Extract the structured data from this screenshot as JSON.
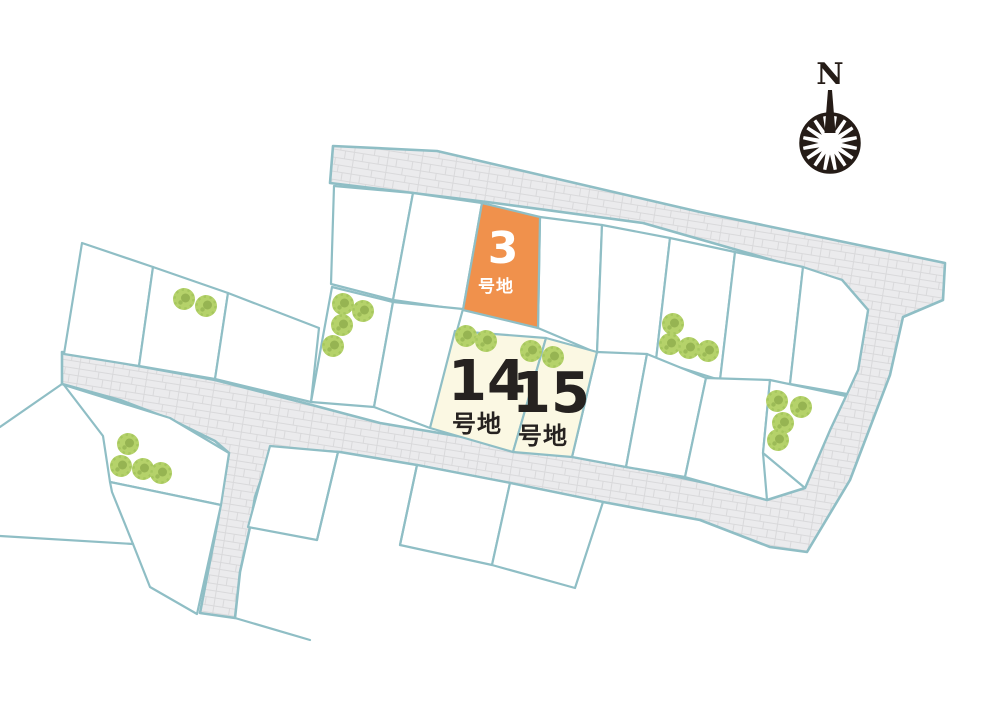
{
  "map": {
    "compass": {
      "label": "N"
    },
    "lots": [
      {
        "id": "lot-3",
        "number": "3",
        "suffix": "号地",
        "fill": "#f0914c",
        "text_color": "#ffffff"
      },
      {
        "id": "lot-14",
        "number": "14",
        "suffix": "号地",
        "fill": "#fbf8e3",
        "text_color": "#262220"
      },
      {
        "id": "lot-15",
        "number": "15",
        "suffix": "号地",
        "fill": "#fbf8e3",
        "text_color": "#262220"
      }
    ],
    "colors": {
      "highlight_orange": "#f0914c",
      "highlight_cream": "#fbf8e3",
      "parcel_border": "#8fbec5",
      "road_fill": "#ebebed",
      "road_brick_line": "#d9d9db",
      "tree_green": "#b5d26a",
      "compass_ink": "#251c17"
    },
    "icons": [
      "compass-rose-icon",
      "tree-icon"
    ]
  }
}
